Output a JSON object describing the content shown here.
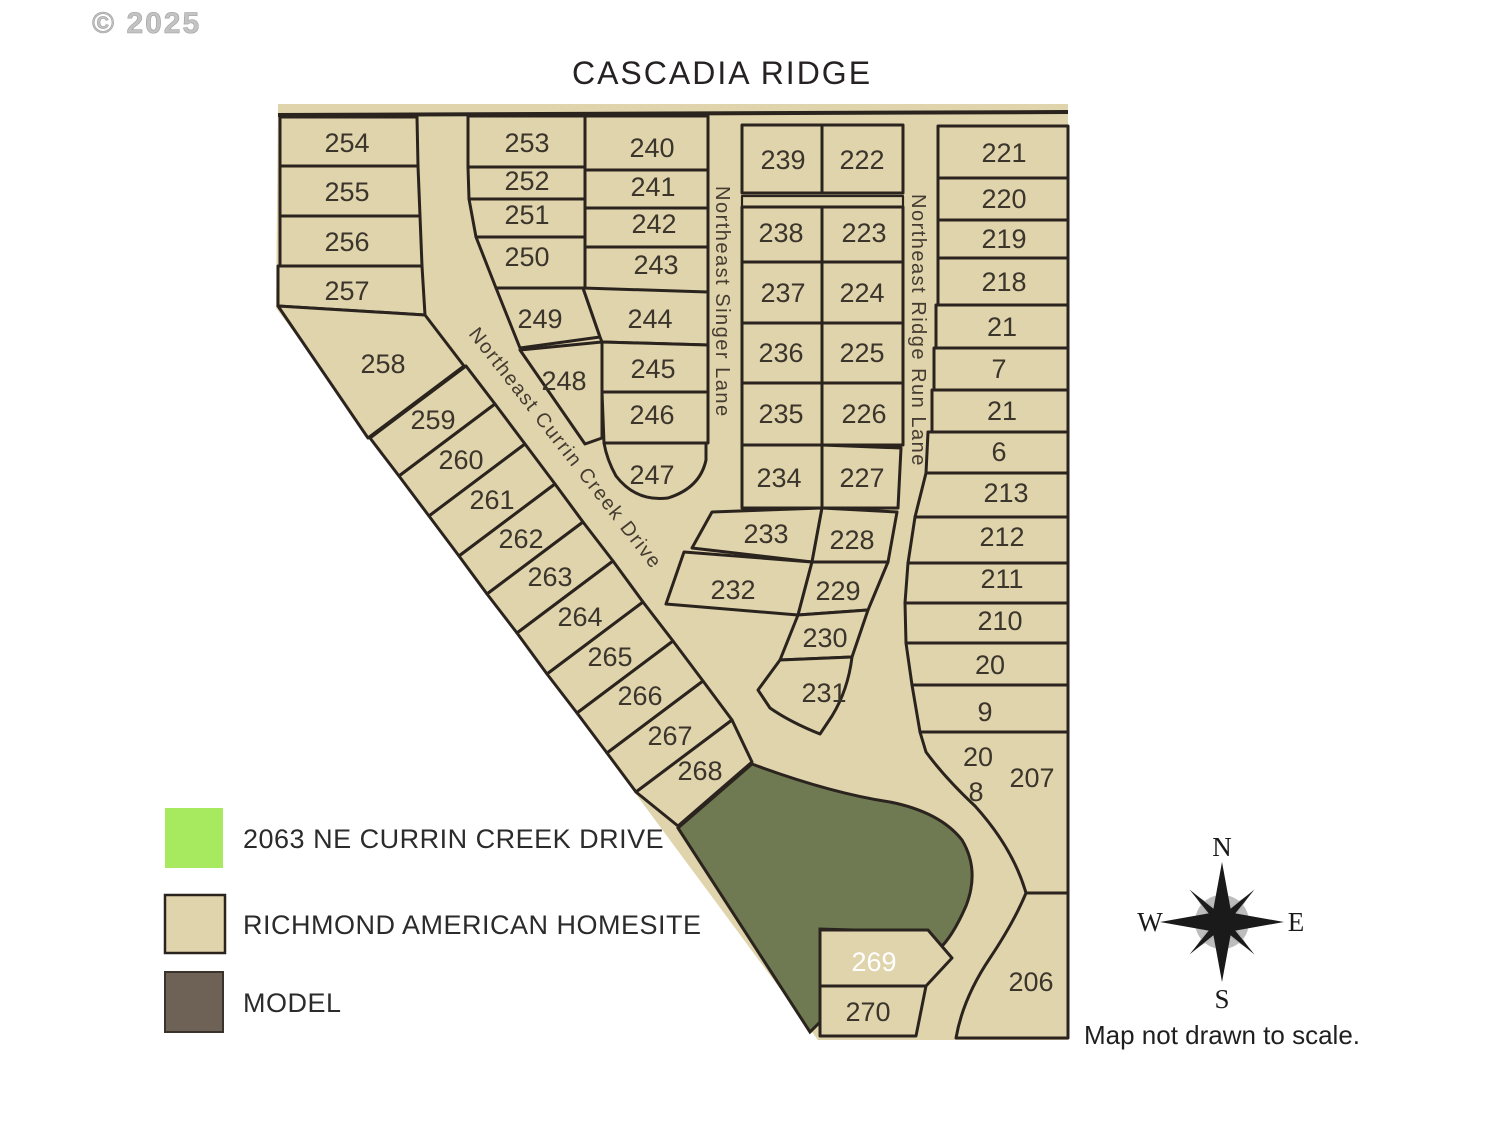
{
  "copyright": "© 2025",
  "title": "CASCADIA RIDGE",
  "note": "Map not drawn to scale.",
  "colors": {
    "homesite": "#e0d4ac",
    "highlight": "#a8ea5f",
    "model": "#6e6156",
    "open_space": "#6f7a52",
    "line": "#2b241e"
  },
  "roads": {
    "currin": "Northeast Currin Creek Drive",
    "singer": "Northeast Singer Lane",
    "ridge": "Northeast Ridge Run Lane"
  },
  "legend": {
    "items": [
      {
        "label": "2063 NE CURRIN CREEK DRIVE",
        "color": "#a8ea5f"
      },
      {
        "label": "RICHMOND AMERICAN HOMESITE",
        "color": "#e0d4ac"
      },
      {
        "label": "MODEL",
        "color": "#6e6156"
      }
    ]
  },
  "compass": {
    "north": "N",
    "east": "E",
    "south": "S",
    "west": "W"
  },
  "lots": {
    "left_column": [
      "254",
      "255",
      "256",
      "257"
    ],
    "diagonal_row": [
      "258",
      "259",
      "260",
      "261",
      "262",
      "263",
      "264",
      "265",
      "266",
      "267",
      "268"
    ],
    "block_b_left": [
      "253",
      "252",
      "251",
      "250",
      "249",
      "248",
      "247"
    ],
    "block_b_right": [
      "240",
      "241",
      "242",
      "243",
      "244",
      "245",
      "246"
    ],
    "block_c_left": [
      "239",
      "238",
      "237",
      "236",
      "235",
      "234",
      "233",
      "232"
    ],
    "block_c_right": [
      "222",
      "223",
      "224",
      "225",
      "226",
      "227",
      "228",
      "229",
      "230",
      "231"
    ],
    "right_column": [
      "221",
      "220",
      "219",
      "218",
      "21",
      "7",
      "21",
      "6",
      "213",
      "212",
      "211",
      "210",
      "20",
      "9",
      "20",
      "8",
      "207",
      "206"
    ],
    "south_lots": [
      "269",
      "270"
    ]
  }
}
